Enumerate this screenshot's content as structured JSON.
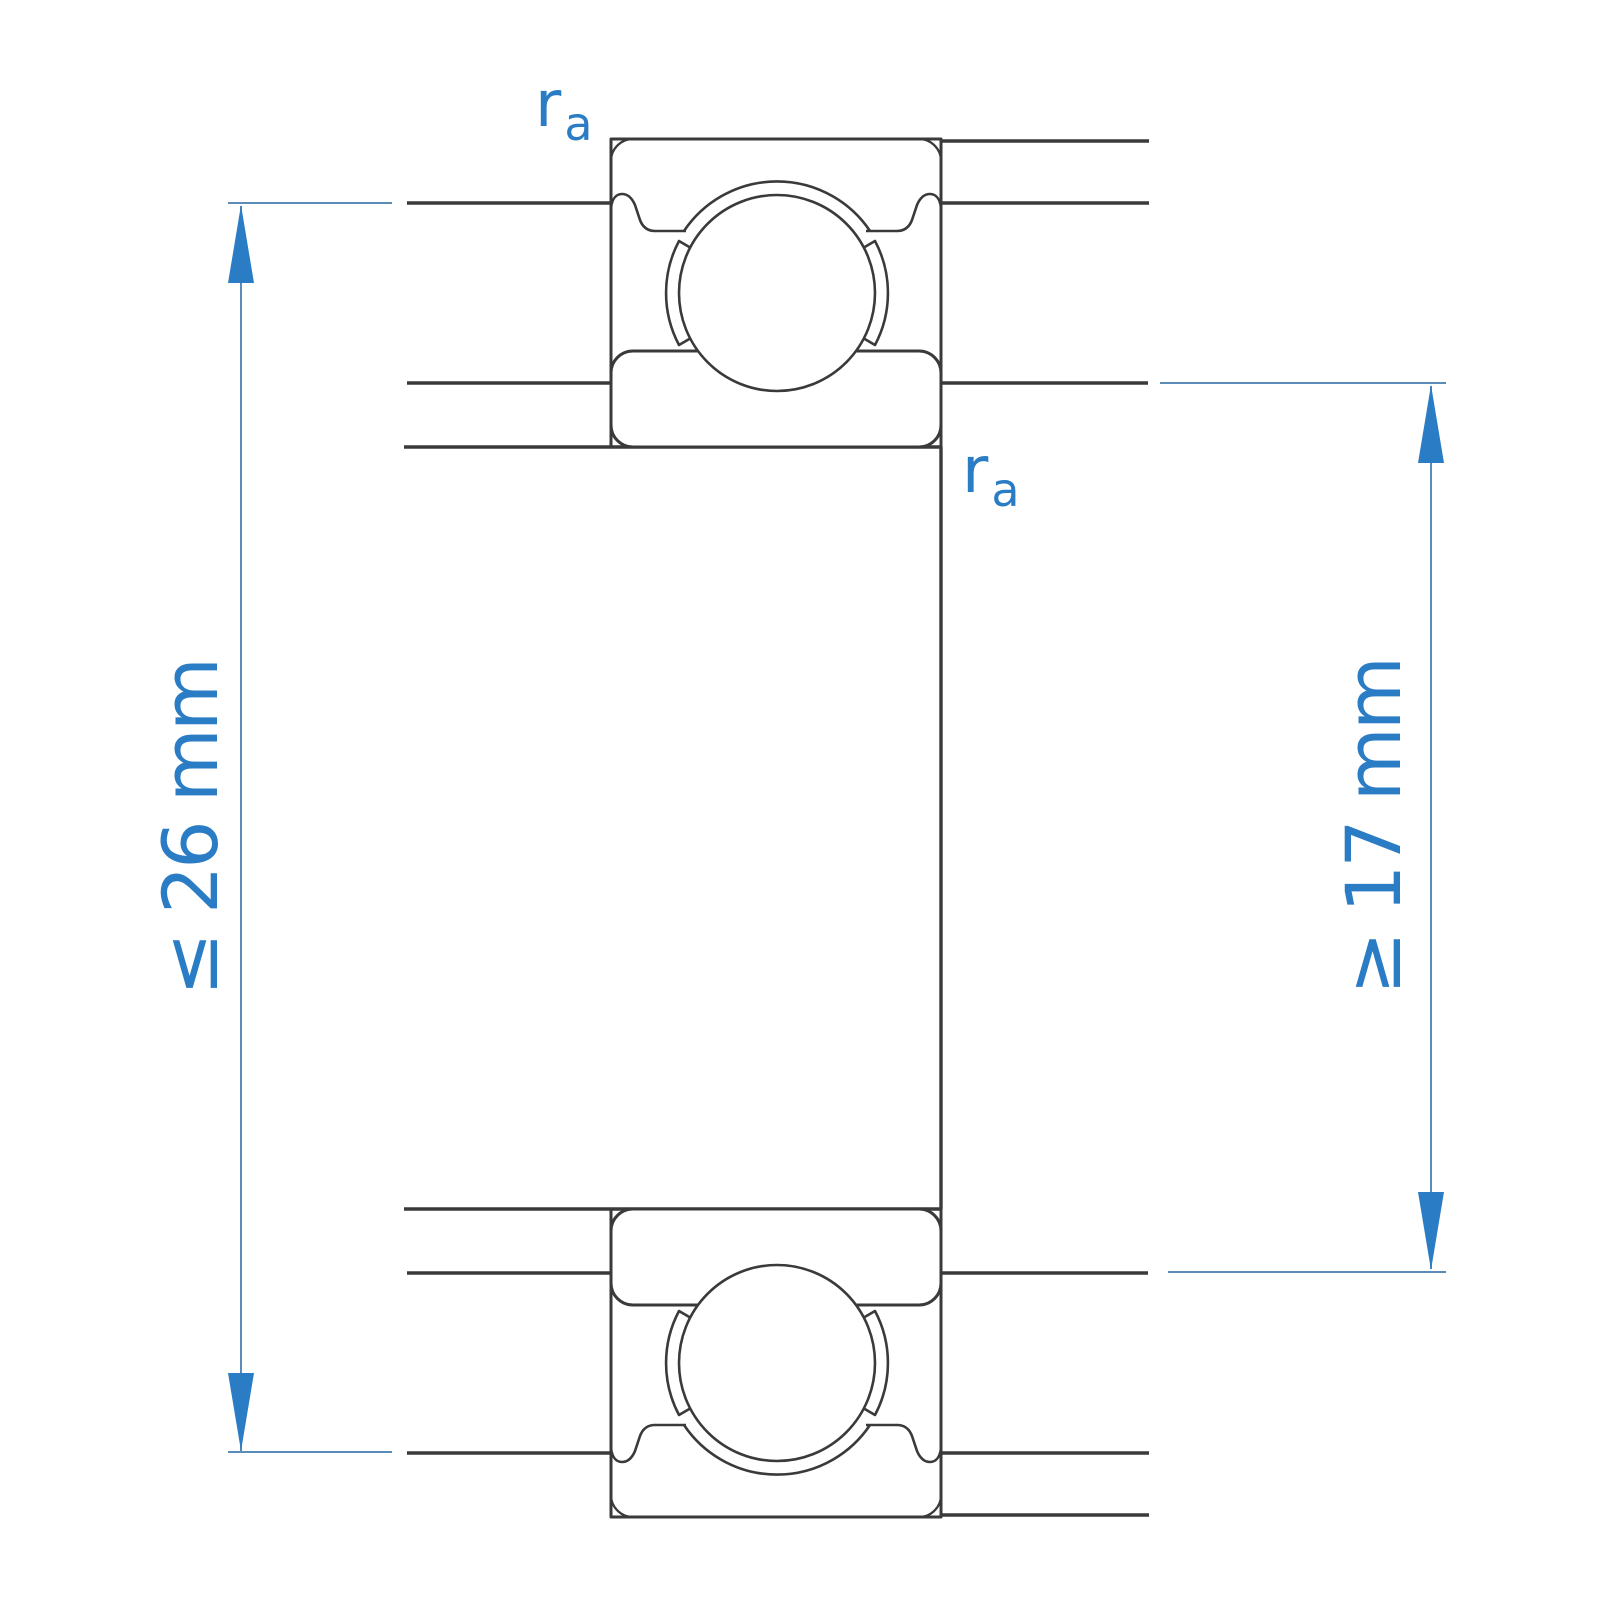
{
  "diagram": {
    "description": "Deep groove ball bearing cross-section with abutment (mounting) dimensions",
    "dimensions": {
      "housing_abutment": {
        "label": "≤ 26 mm",
        "side": "left"
      },
      "shaft_abutment": {
        "label": "≥ 17 mm",
        "side": "right"
      }
    },
    "fillet_label": {
      "symbol": "r",
      "subscript": "a"
    },
    "colors": {
      "accent_blue": "#2a7cc4",
      "accent_blue_thin": "#5b8cb8",
      "line_dark": "#3a3a3a",
      "background": "#ffffff"
    }
  }
}
